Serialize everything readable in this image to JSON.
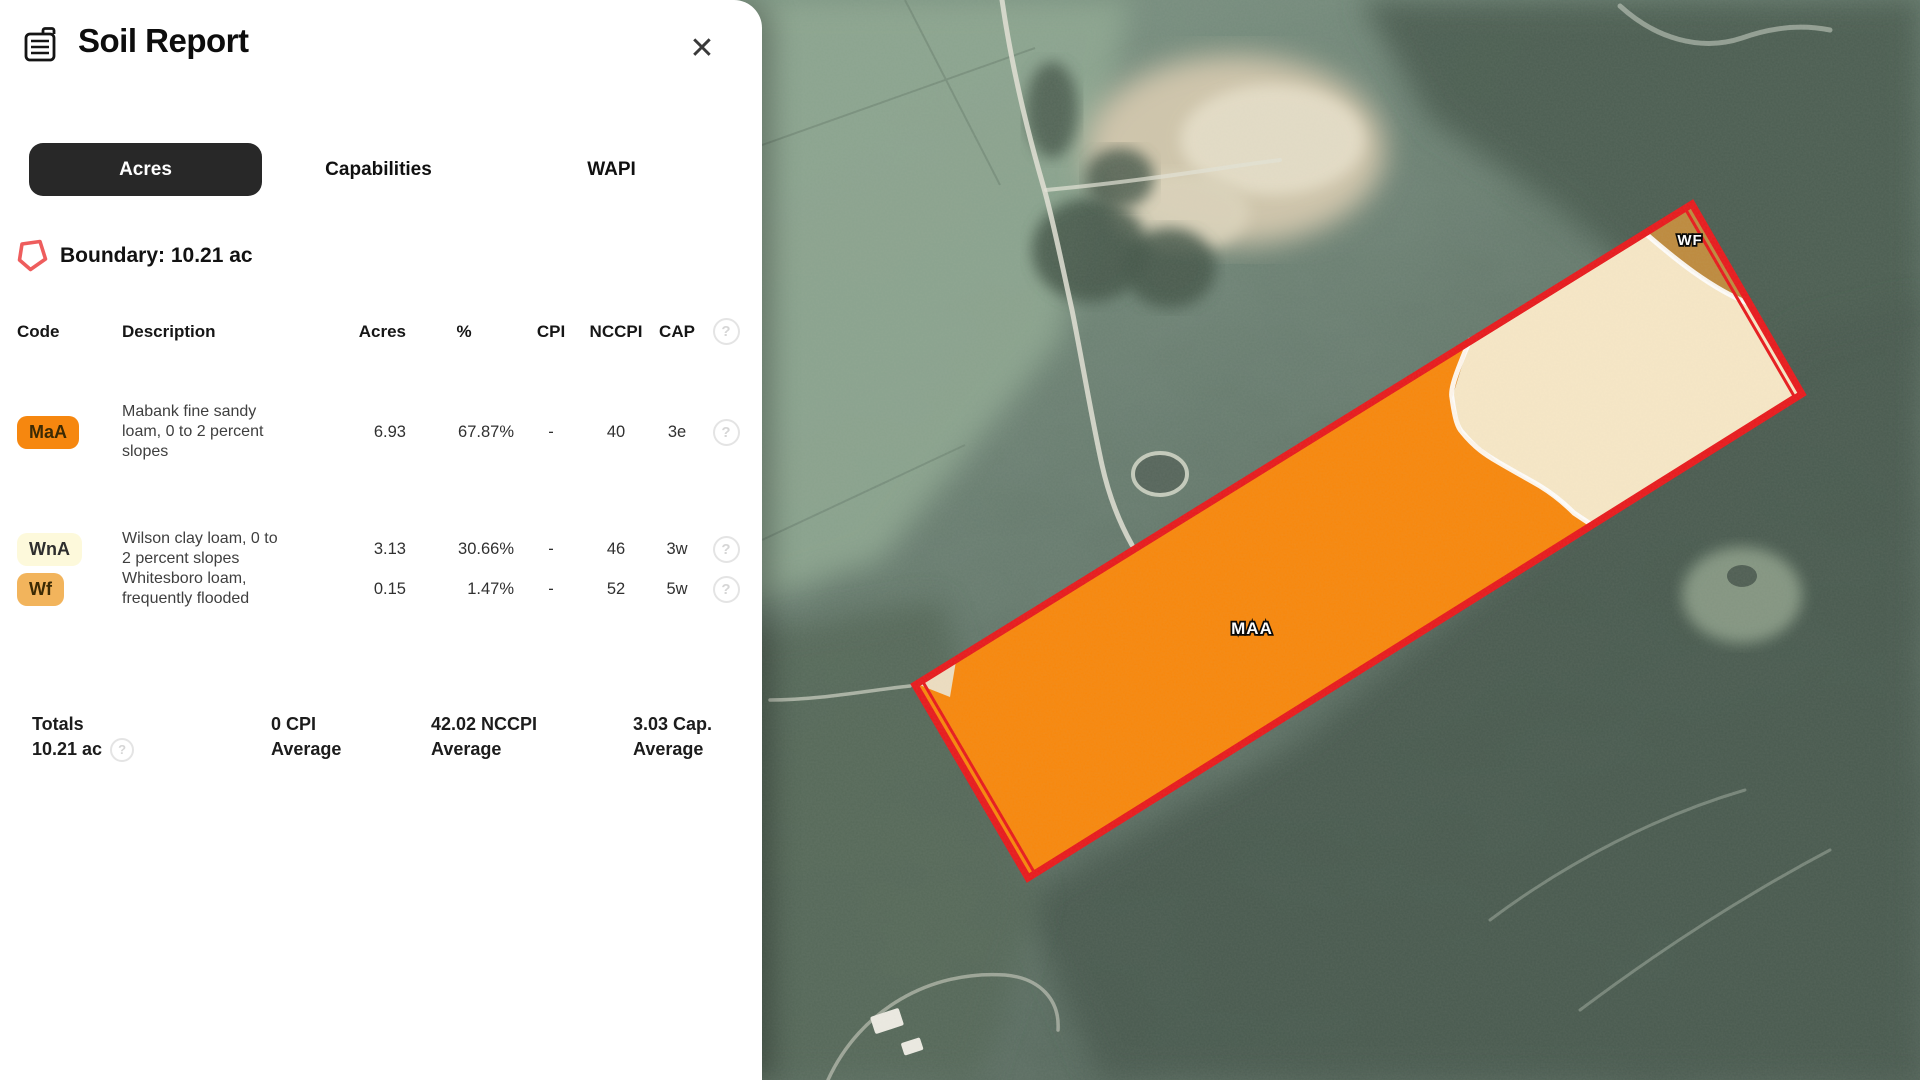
{
  "panel": {
    "title": "Soil Report",
    "icons": {
      "close": "✕",
      "help": "?"
    },
    "tabs": [
      {
        "label": "Acres",
        "active": true
      },
      {
        "label": "Capabilities",
        "active": false
      },
      {
        "label": "WAPI",
        "active": false
      }
    ],
    "boundary": {
      "label": "Boundary: 10.21 ac"
    },
    "table": {
      "headers": {
        "code": "Code",
        "description": "Description",
        "acres": "Acres",
        "percent": "%",
        "cpi": "CPI",
        "nccpi": "NCCPI",
        "cap": "CAP"
      },
      "rows": [
        {
          "code": "MaA",
          "description": "Mabank fine sandy loam, 0 to 2 percent slopes",
          "acres": "6.93",
          "percent": "67.87%",
          "cpi": "-",
          "nccpi": "40",
          "cap": "3e",
          "badge_color": "#F6870F"
        },
        {
          "code": "WnA",
          "description": "Wilson clay loam, 0 to 2 percent slopes",
          "acres": "3.13",
          "percent": "30.66%",
          "cpi": "-",
          "nccpi": "46",
          "cap": "3w",
          "badge_color": "#FDF9DB"
        },
        {
          "code": "Wf",
          "description": "Whitesboro loam, frequently flooded",
          "acres": "0.15",
          "percent": "1.47%",
          "cpi": "-",
          "nccpi": "52",
          "cap": "5w",
          "badge_color": "#F2B45C"
        }
      ]
    },
    "totals": {
      "label": "Totals",
      "acres": "10.21 ac",
      "cpi_value": "0 CPI",
      "cpi_label": "Average",
      "nccpi_value": "42.02 NCCPI",
      "nccpi_label": "Average",
      "cap_value": "3.03 Cap.",
      "cap_label": "Average"
    }
  },
  "map": {
    "labels": {
      "maa": "MAA",
      "wf": "WF"
    },
    "colors": {
      "boundary_red": "#E8191C",
      "maa_fill": "#F8870B",
      "wna_fill": "#F7E7C6",
      "wf_fill": "#BE8A3D"
    }
  }
}
